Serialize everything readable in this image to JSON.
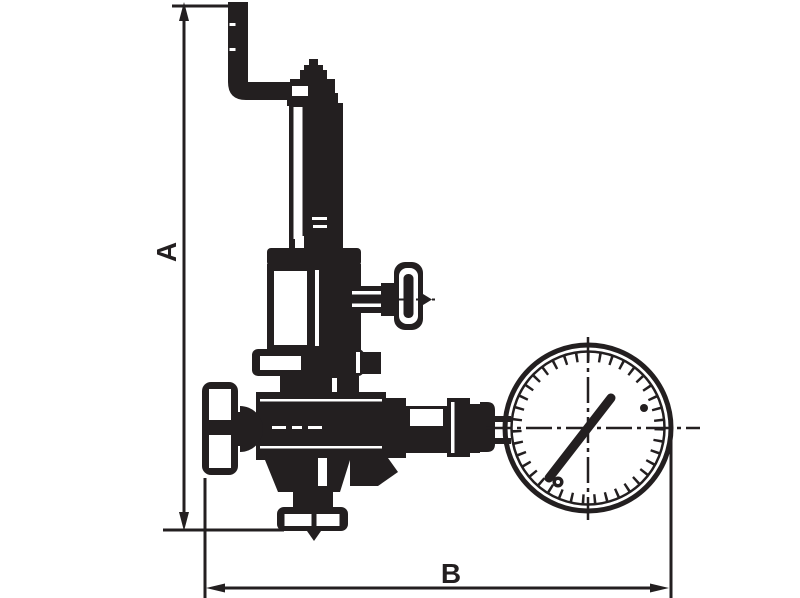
{
  "drawing": {
    "type": "technical-dimension-drawing",
    "subject": "pressure-reducing-valve-with-gauge",
    "colors": {
      "ink": "#231f20",
      "background": "#ffffff"
    },
    "labels": {
      "a": "A",
      "b": "B"
    },
    "dimensions": [
      {
        "label": "A",
        "orientation": "vertical",
        "measures": "overall-height-of-valve"
      },
      {
        "label": "B",
        "orientation": "horizontal",
        "measures": "overall-width-valve-to-gauge"
      }
    ],
    "parts": [
      "adjustment-crank-handle",
      "stem-cap",
      "bonnet-tube",
      "bonnet-flange",
      "spring-housing",
      "side-tap-handwheel",
      "upper-body-flange",
      "valve-body",
      "inlet-handwheel",
      "bottom-outlet-flange",
      "outlet-fittings",
      "pressure-gauge"
    ],
    "gauge": {
      "needle_direction": "up-right",
      "tick_ring": true,
      "crosshair_centerlines": true
    }
  }
}
